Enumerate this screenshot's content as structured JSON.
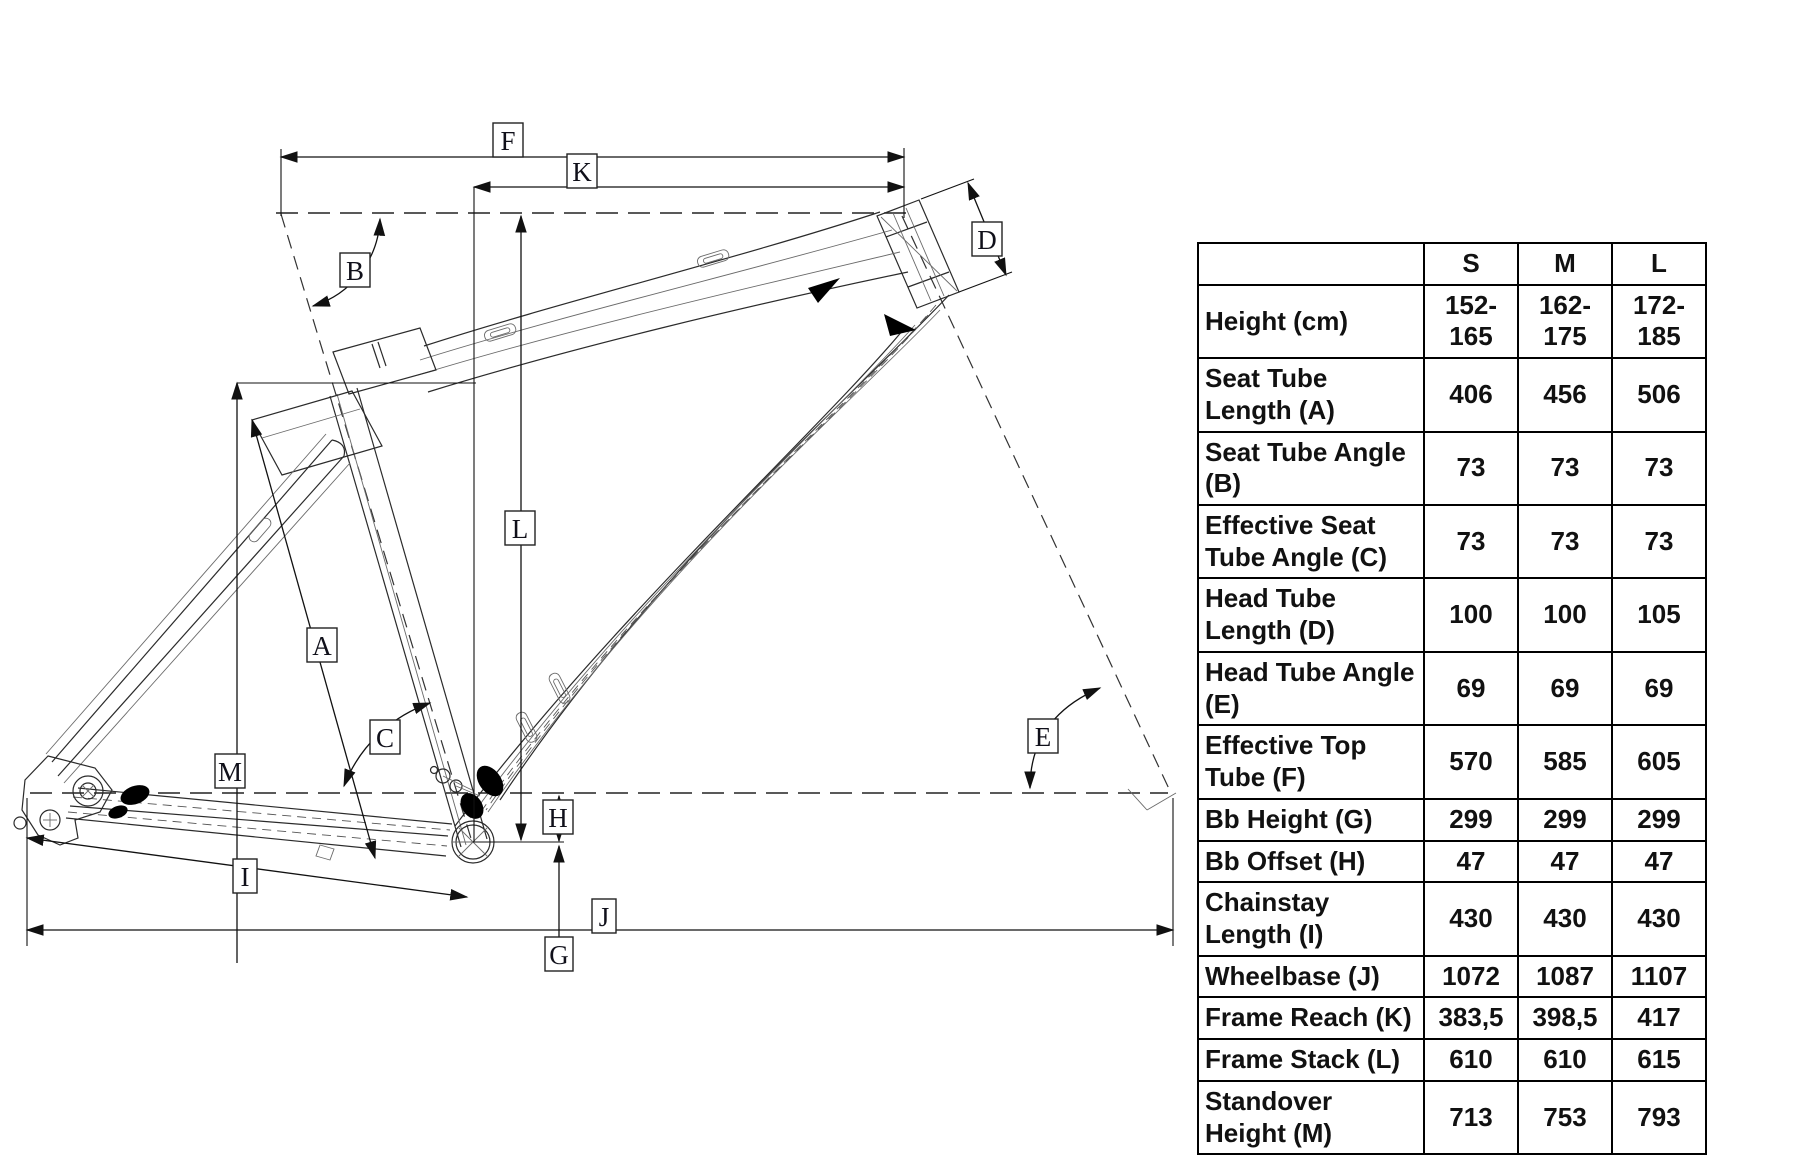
{
  "diagram": {
    "labels": {
      "F": "F",
      "K": "K",
      "B": "B",
      "D": "D",
      "A": "A",
      "C": "C",
      "L": "L",
      "M": "M",
      "E": "E",
      "H": "H",
      "I": "I",
      "J": "J",
      "G": "G"
    }
  },
  "table": {
    "corner": "",
    "columns": [
      "S",
      "M",
      "L"
    ],
    "rows": [
      {
        "label": "Height (cm)",
        "values": [
          "152-165",
          "162-175",
          "172-185"
        ]
      },
      {
        "label": "Seat Tube Length (A)",
        "values": [
          "406",
          "456",
          "506"
        ]
      },
      {
        "label": "Seat Tube Angle (B)",
        "values": [
          "73",
          "73",
          "73"
        ]
      },
      {
        "label": "Effective Seat Tube Angle (C)",
        "values": [
          "73",
          "73",
          "73"
        ]
      },
      {
        "label": "Head Tube Length (D)",
        "values": [
          "100",
          "100",
          "105"
        ]
      },
      {
        "label": "Head Tube Angle (E)",
        "values": [
          "69",
          "69",
          "69"
        ]
      },
      {
        "label": "Effective Top Tube (F)",
        "values": [
          "570",
          "585",
          "605"
        ]
      },
      {
        "label": "Bb Height (G)",
        "values": [
          "299",
          "299",
          "299"
        ]
      },
      {
        "label": "Bb Offset (H)",
        "values": [
          "47",
          "47",
          "47"
        ]
      },
      {
        "label": "Chainstay Length (I)",
        "values": [
          "430",
          "430",
          "430"
        ]
      },
      {
        "label": "Wheelbase (J)",
        "values": [
          "1072",
          "1087",
          "1107"
        ]
      },
      {
        "label": "Frame Reach (K)",
        "values": [
          "383,5",
          "398,5",
          "417"
        ]
      },
      {
        "label": "Frame Stack (L)",
        "values": [
          "610",
          "610",
          "615"
        ]
      },
      {
        "label": "Standover Height (M)",
        "values": [
          "713",
          "753",
          "793"
        ]
      }
    ]
  }
}
